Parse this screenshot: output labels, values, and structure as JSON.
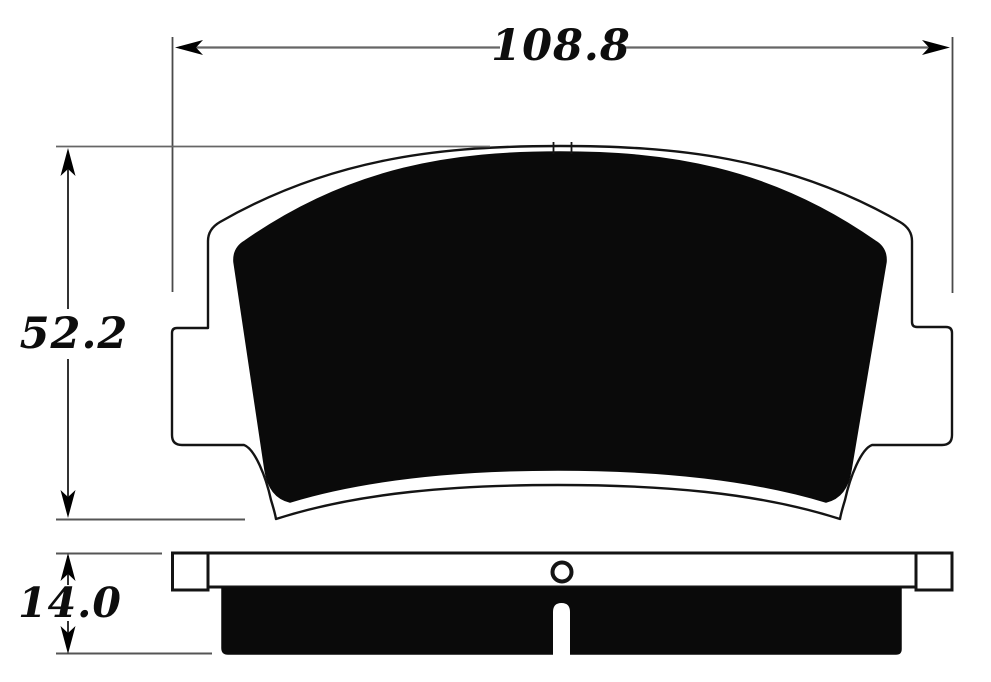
{
  "drawing": {
    "type": "technical-dimension-drawing",
    "subject": "brake-pad",
    "views": {
      "front_view": "brake pad face with backing plate, mounting ears and friction material",
      "side_view": "brake pad edge profile with backing plate, rivet hole and friction material with center slot"
    },
    "dimensions": {
      "width": "108.8",
      "height": "52.2",
      "thickness": "14.0"
    },
    "colors": {
      "background": "#ffffff",
      "outline": "#141414",
      "friction_fill": "#0a0a0a",
      "dim_line": "#666666",
      "ext_line": "#4a4a4a",
      "text": "#0d0d0d",
      "arrow": "#000000"
    }
  }
}
